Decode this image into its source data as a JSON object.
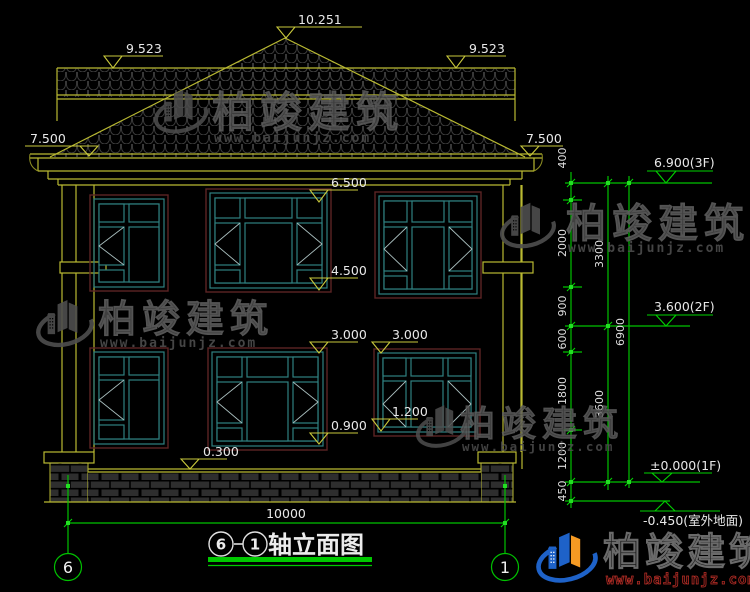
{
  "watermark": {
    "name": "柏竣建筑",
    "url": "www.baijunjz.com"
  },
  "title": {
    "axis_from": "6",
    "axis_to": "1",
    "text": "轴立面图"
  },
  "axes": {
    "left": "6",
    "right": "1"
  },
  "levels_left": {
    "ridge": "10.251",
    "roof_band_left": "9.523",
    "roof_band_right": "9.523",
    "eave_left": "7.500",
    "eave_right": "7.500",
    "floor2_window_top": "6.500",
    "floor2_window_sill": "4.500",
    "floor1_window_top_left": "3.000",
    "floor1_window_top_right": "3.000",
    "floor1_window_sill": "0.900",
    "floor1_window_sill_right": "1.200",
    "plinth_top": "0.300"
  },
  "levels_right": {
    "floor3": "6.900(3F)",
    "floor2": "3.600(2F)",
    "floor1": "±0.000(1F)",
    "ground": "-0.450(室外地面)"
  },
  "dimensions": {
    "inner_chain": [
      "400",
      "2000",
      "900",
      "600",
      "1800",
      "1200",
      "450"
    ],
    "middle_chain": [
      "3300",
      "3600"
    ],
    "outer_chain": [
      "6900"
    ],
    "total_width": "10000"
  },
  "colors": {
    "line_yellow": "#b9b932",
    "line_green": "#00c200",
    "window_teal": "#2f8080",
    "frame_red": "#5c2424",
    "text_white": "#e8e8e8",
    "watermark_gray": "#4d4d4d",
    "logo_blue": "#1e62c8",
    "logo_orange": "#f59a23"
  }
}
